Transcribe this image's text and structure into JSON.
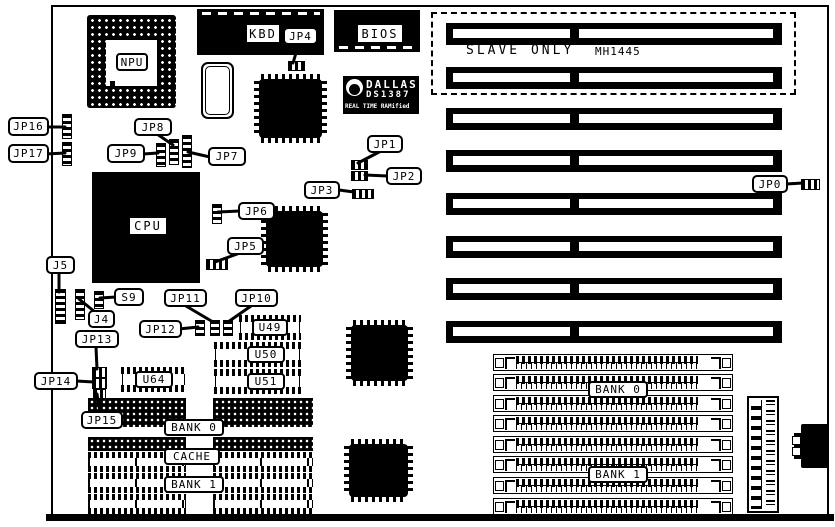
{
  "diagram": {
    "callouts": {
      "jp0": "JP0",
      "jp1": "JP1",
      "jp2": "JP2",
      "jp3": "JP3",
      "jp4": "JP4",
      "jp5": "JP5",
      "jp6": "JP6",
      "jp7": "JP7",
      "jp8": "JP8",
      "jp9": "JP9",
      "jp10": "JP10",
      "jp11": "JP11",
      "jp12": "JP12",
      "jp13": "JP13",
      "jp14": "JP14",
      "jp15": "JP15",
      "jp16": "JP16",
      "jp17": "JP17",
      "j4": "J4",
      "j5": "J5",
      "s9": "S9"
    },
    "chips": {
      "npu": "NPU",
      "cpu": "CPU",
      "kbd": "KBD",
      "bios": "BIOS",
      "u49": "U49",
      "u50": "U50",
      "u51": "U51",
      "u64": "U64"
    },
    "rtc": {
      "brand": "DALLAS",
      "part": "DS1387",
      "tagline": "REAL TIME RAMified"
    },
    "expansion": {
      "slave_only": "SLAVE ONLY",
      "model": "MH1445"
    },
    "memory": {
      "left_bank0": "BANK 0",
      "left_cache": "CACHE",
      "left_bank1": "BANK 1",
      "right_bank0": "BANK 0",
      "right_bank1": "BANK 1"
    }
  }
}
